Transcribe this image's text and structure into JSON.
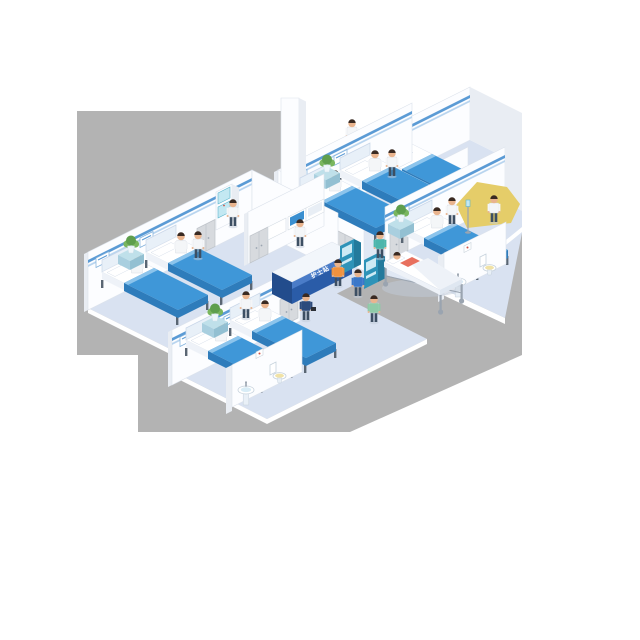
{
  "title": "Isometric hospital ward illustration",
  "nurse_station": {
    "label": "护士站"
  },
  "palette": {
    "background": "#ffffff",
    "backdrop": "#b3b3b3",
    "floor": "#d9e2f1",
    "floorLight": "#e0e8f4",
    "rim": "#ffffff",
    "wall": "#fcfdff",
    "wallShade": "#e9edf3",
    "wallEdge": "#dde3ec",
    "stripeBlue": "#5b9bd5",
    "stripeLight": "#b9d5ef",
    "bedBlanket": "#3f97d8",
    "bedBlanketDark": "#2e7cbb",
    "blanketFold": "#8cc4ec",
    "mattress": "#ffffff",
    "mattressSide": "#eef2f8",
    "bedFoot": "#dfe7f1",
    "headboard": "#e8f0f8",
    "bedFrame": "#c9d6e8",
    "legGray": "#5a6673",
    "deskBlue": "#2a5ca8",
    "deskBlueDark": "#224c8c",
    "deskBand": "#4a7cc8",
    "deskTop": "#f2f6fb",
    "labelText": "#ffffff",
    "kioskTeal": "#2e93b8",
    "kioskTealDark": "#237a9c",
    "kioskTop": "#bfe2ee",
    "screenLight": "#cdeaf4",
    "screenBlue": "#3a8fd0",
    "screenPale": "#e8eef5",
    "tealLight": "#c3e8f2",
    "tealStroke": "#5ab4cc",
    "plantGreen": "#5e9e4d",
    "plantGreenLight": "#79b65e",
    "plantTable": "#bfe0ea",
    "plantTableFront": "#a9cfdf",
    "plantTableSide": "#93c0d2",
    "potWhite": "#eef6fa",
    "skin": "#e9b48e",
    "hair": "#3a2a22",
    "coat": "#f4f6f8",
    "scrubTeal": "#4db6ac",
    "scrubGreen": "#8fcba8",
    "navy": "#2c4a7c",
    "blue": "#3a77c9",
    "orange": "#f0923e",
    "coral": "#e8705e",
    "pants": "#3d4f63",
    "doorGray": "#d7dade",
    "doorFrame": "#bfc4ca",
    "metal": "#9aa4b0",
    "yellow": "#e5cd69",
    "red": "#d05043",
    "seatYellow": "#f0e2a6",
    "fixtureFill": "#ffffff",
    "fixtureStroke": "#c6d2dc",
    "pedestal": "#e9f0f7",
    "shadow": "#c2cbda"
  },
  "scene": {
    "type": "isometric-hospital-ward",
    "rooms": [
      {
        "name": "left patient room",
        "beds": 2,
        "patients": 2,
        "staff": 1
      },
      {
        "name": "front patient room",
        "beds": 2,
        "patients": 2,
        "staff": 1
      },
      {
        "name": "top patient room",
        "beds": 2,
        "patients": 2,
        "staff": 1
      },
      {
        "name": "upper-right patient room",
        "beds": 1,
        "patients": 0,
        "staff": 1
      },
      {
        "name": "right private room",
        "beds": 1,
        "patients": 1,
        "staff": 2
      }
    ],
    "bathrooms": 3,
    "corridor": {
      "nurse_station_desk": 1,
      "wall_monitors": 3,
      "self_service_kiosks": 2,
      "stretcher": 1,
      "walking_people": 3
    }
  }
}
